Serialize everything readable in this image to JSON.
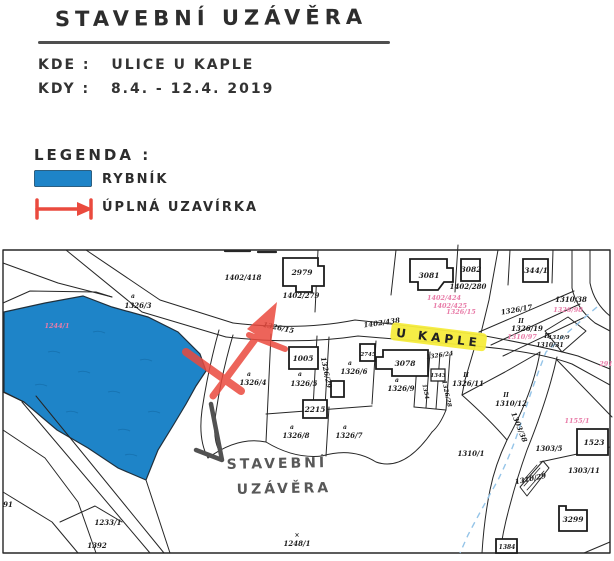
{
  "document": {
    "title": "STAVEBNÍ UZÁVĚRA",
    "where_label": "KDE :",
    "where_value": "ULICE U KAPLE",
    "when_label": "KDY :",
    "when_value": "8.4. - 12.4. 2019",
    "legend": {
      "heading": "LEGENDA :",
      "items": [
        {
          "symbol": "pond-swatch",
          "label": "RYBNÍK",
          "color": "#1e84c8"
        },
        {
          "symbol": "closure-barrier",
          "label": "ÚPLNÁ UZAVÍRKA",
          "color": "#ea4a3e"
        }
      ]
    }
  },
  "map": {
    "street_highlight": {
      "text": "U KAPLE",
      "highlight_color": "#f6ec3c"
    },
    "annotation": {
      "line1": "STAVEBNÍ",
      "line2": "UZÁVĚRA"
    },
    "colors": {
      "pond": "#1e84c8",
      "closure": "#ea4a3e",
      "highlight": "#f6ec3c",
      "parcel_pink": "#e87ca8",
      "stream": "#94c4e8",
      "pencil": "#525252"
    },
    "labels": [
      {
        "text": "1402/418",
        "x": 243,
        "y": 280
      },
      {
        "text": "1402/279",
        "x": 301,
        "y": 298
      },
      {
        "text": "1402/280",
        "x": 468,
        "y": 289
      },
      {
        "text": "1402/424",
        "x": 444,
        "y": 300,
        "cls": "pink"
      },
      {
        "text": "1402/425",
        "x": 450,
        "y": 308,
        "cls": "pink"
      },
      {
        "text": "1326/15",
        "x": 461,
        "y": 314,
        "cls": "pink"
      },
      {
        "text": "1402/438",
        "x": 382,
        "y": 325,
        "rot": -8
      },
      {
        "text": "1326/15",
        "x": 278,
        "y": 330,
        "rot": 12
      },
      {
        "text": "1310/38",
        "x": 571,
        "y": 302
      },
      {
        "text": "1326/98",
        "x": 568,
        "y": 312,
        "cls": "pink"
      },
      {
        "text": "1326/17",
        "x": 517,
        "y": 312,
        "rot": -10
      },
      {
        "text": "II",
        "x": 521,
        "y": 323,
        "cls": "am"
      },
      {
        "text": "1326/19",
        "x": 527,
        "y": 331
      },
      {
        "text": "1310/97",
        "x": 522,
        "y": 339,
        "cls": "pink"
      },
      {
        "text": "II",
        "x": 547,
        "y": 338,
        "cls": "am"
      },
      {
        "text": "1310/9",
        "x": 559,
        "y": 339,
        "size": 5.5
      },
      {
        "text": "1310/31",
        "x": 550,
        "y": 347,
        "size": 6
      },
      {
        "text": "1244/1",
        "x": 57,
        "y": 328,
        "cls": "pink"
      },
      {
        "text": "a",
        "x": 133,
        "y": 298,
        "cls": "am"
      },
      {
        "text": "1326/3",
        "x": 138,
        "y": 308
      },
      {
        "text": "a",
        "x": 249,
        "y": 376,
        "cls": "am"
      },
      {
        "text": "1326/4",
        "x": 253,
        "y": 385
      },
      {
        "text": "a",
        "x": 300,
        "y": 376,
        "cls": "am"
      },
      {
        "text": "1326/5",
        "x": 304,
        "y": 386
      },
      {
        "text": "1326/29",
        "x": 324,
        "y": 373,
        "rot": 78
      },
      {
        "text": "a",
        "x": 350,
        "y": 365,
        "cls": "am"
      },
      {
        "text": "1326/6",
        "x": 354,
        "y": 374
      },
      {
        "text": "a",
        "x": 397,
        "y": 382,
        "cls": "am"
      },
      {
        "text": "1326/9",
        "x": 401,
        "y": 391
      },
      {
        "text": "1354",
        "x": 424,
        "y": 392,
        "rot": 78,
        "size": 5.5
      },
      {
        "text": "1326/28",
        "x": 445,
        "y": 394,
        "rot": 78,
        "size": 6
      },
      {
        "text": "1326/24",
        "x": 440,
        "y": 357,
        "rot": -8,
        "size": 6
      },
      {
        "text": "II",
        "x": 466,
        "y": 377,
        "cls": "am"
      },
      {
        "text": "1326/11",
        "x": 468,
        "y": 386
      },
      {
        "text": "a",
        "x": 292,
        "y": 429,
        "cls": "am"
      },
      {
        "text": "1326/8",
        "x": 296,
        "y": 438
      },
      {
        "text": "a",
        "x": 345,
        "y": 429,
        "cls": "am"
      },
      {
        "text": "1326/7",
        "x": 349,
        "y": 438
      },
      {
        "text": "II",
        "x": 506,
        "y": 397,
        "cls": "am"
      },
      {
        "text": "1310/12",
        "x": 511,
        "y": 406
      },
      {
        "text": "1303/38",
        "x": 517,
        "y": 428,
        "rot": 68
      },
      {
        "text": "1155/1",
        "x": 577,
        "y": 423,
        "cls": "pink"
      },
      {
        "text": "291",
        "x": 606,
        "y": 366,
        "cls": "pink"
      },
      {
        "text": "1310/1",
        "x": 471,
        "y": 456
      },
      {
        "text": "1303/5",
        "x": 549,
        "y": 451
      },
      {
        "text": "1303/11",
        "x": 584,
        "y": 473
      },
      {
        "text": "1310/29",
        "x": 531,
        "y": 481,
        "rot": -12
      },
      {
        "text": "1233/1",
        "x": 108,
        "y": 525
      },
      {
        "text": "1392",
        "x": 97,
        "y": 548
      },
      {
        "text": "×",
        "x": 297,
        "y": 537,
        "cls": "am"
      },
      {
        "text": "1248/1",
        "x": 297,
        "y": 546
      },
      {
        "text": "91",
        "x": 8,
        "y": 507
      },
      {
        "text": "2979",
        "x": 302,
        "y": 275,
        "cls": "bld"
      },
      {
        "text": "3081",
        "x": 429,
        "y": 278,
        "cls": "bld"
      },
      {
        "text": "3082",
        "x": 471,
        "y": 272,
        "cls": "bld"
      },
      {
        "text": "344/1",
        "x": 536,
        "y": 273,
        "cls": "bld"
      },
      {
        "text": "1005",
        "x": 303,
        "y": 361,
        "cls": "bld"
      },
      {
        "text": "2745",
        "x": 368,
        "y": 356,
        "cls": "bld",
        "size": 5.5
      },
      {
        "text": "3078",
        "x": 405,
        "y": 366,
        "cls": "bld"
      },
      {
        "text": "1343",
        "x": 438,
        "y": 377,
        "cls": "bld",
        "size": 5.5
      },
      {
        "text": "2215",
        "x": 315,
        "y": 412,
        "cls": "bld"
      },
      {
        "text": "1523",
        "x": 594,
        "y": 445,
        "cls": "bld"
      },
      {
        "text": "3299",
        "x": 573,
        "y": 522,
        "cls": "bld"
      },
      {
        "text": "1384",
        "x": 507,
        "y": 549,
        "cls": "bld",
        "size": 6
      }
    ]
  }
}
